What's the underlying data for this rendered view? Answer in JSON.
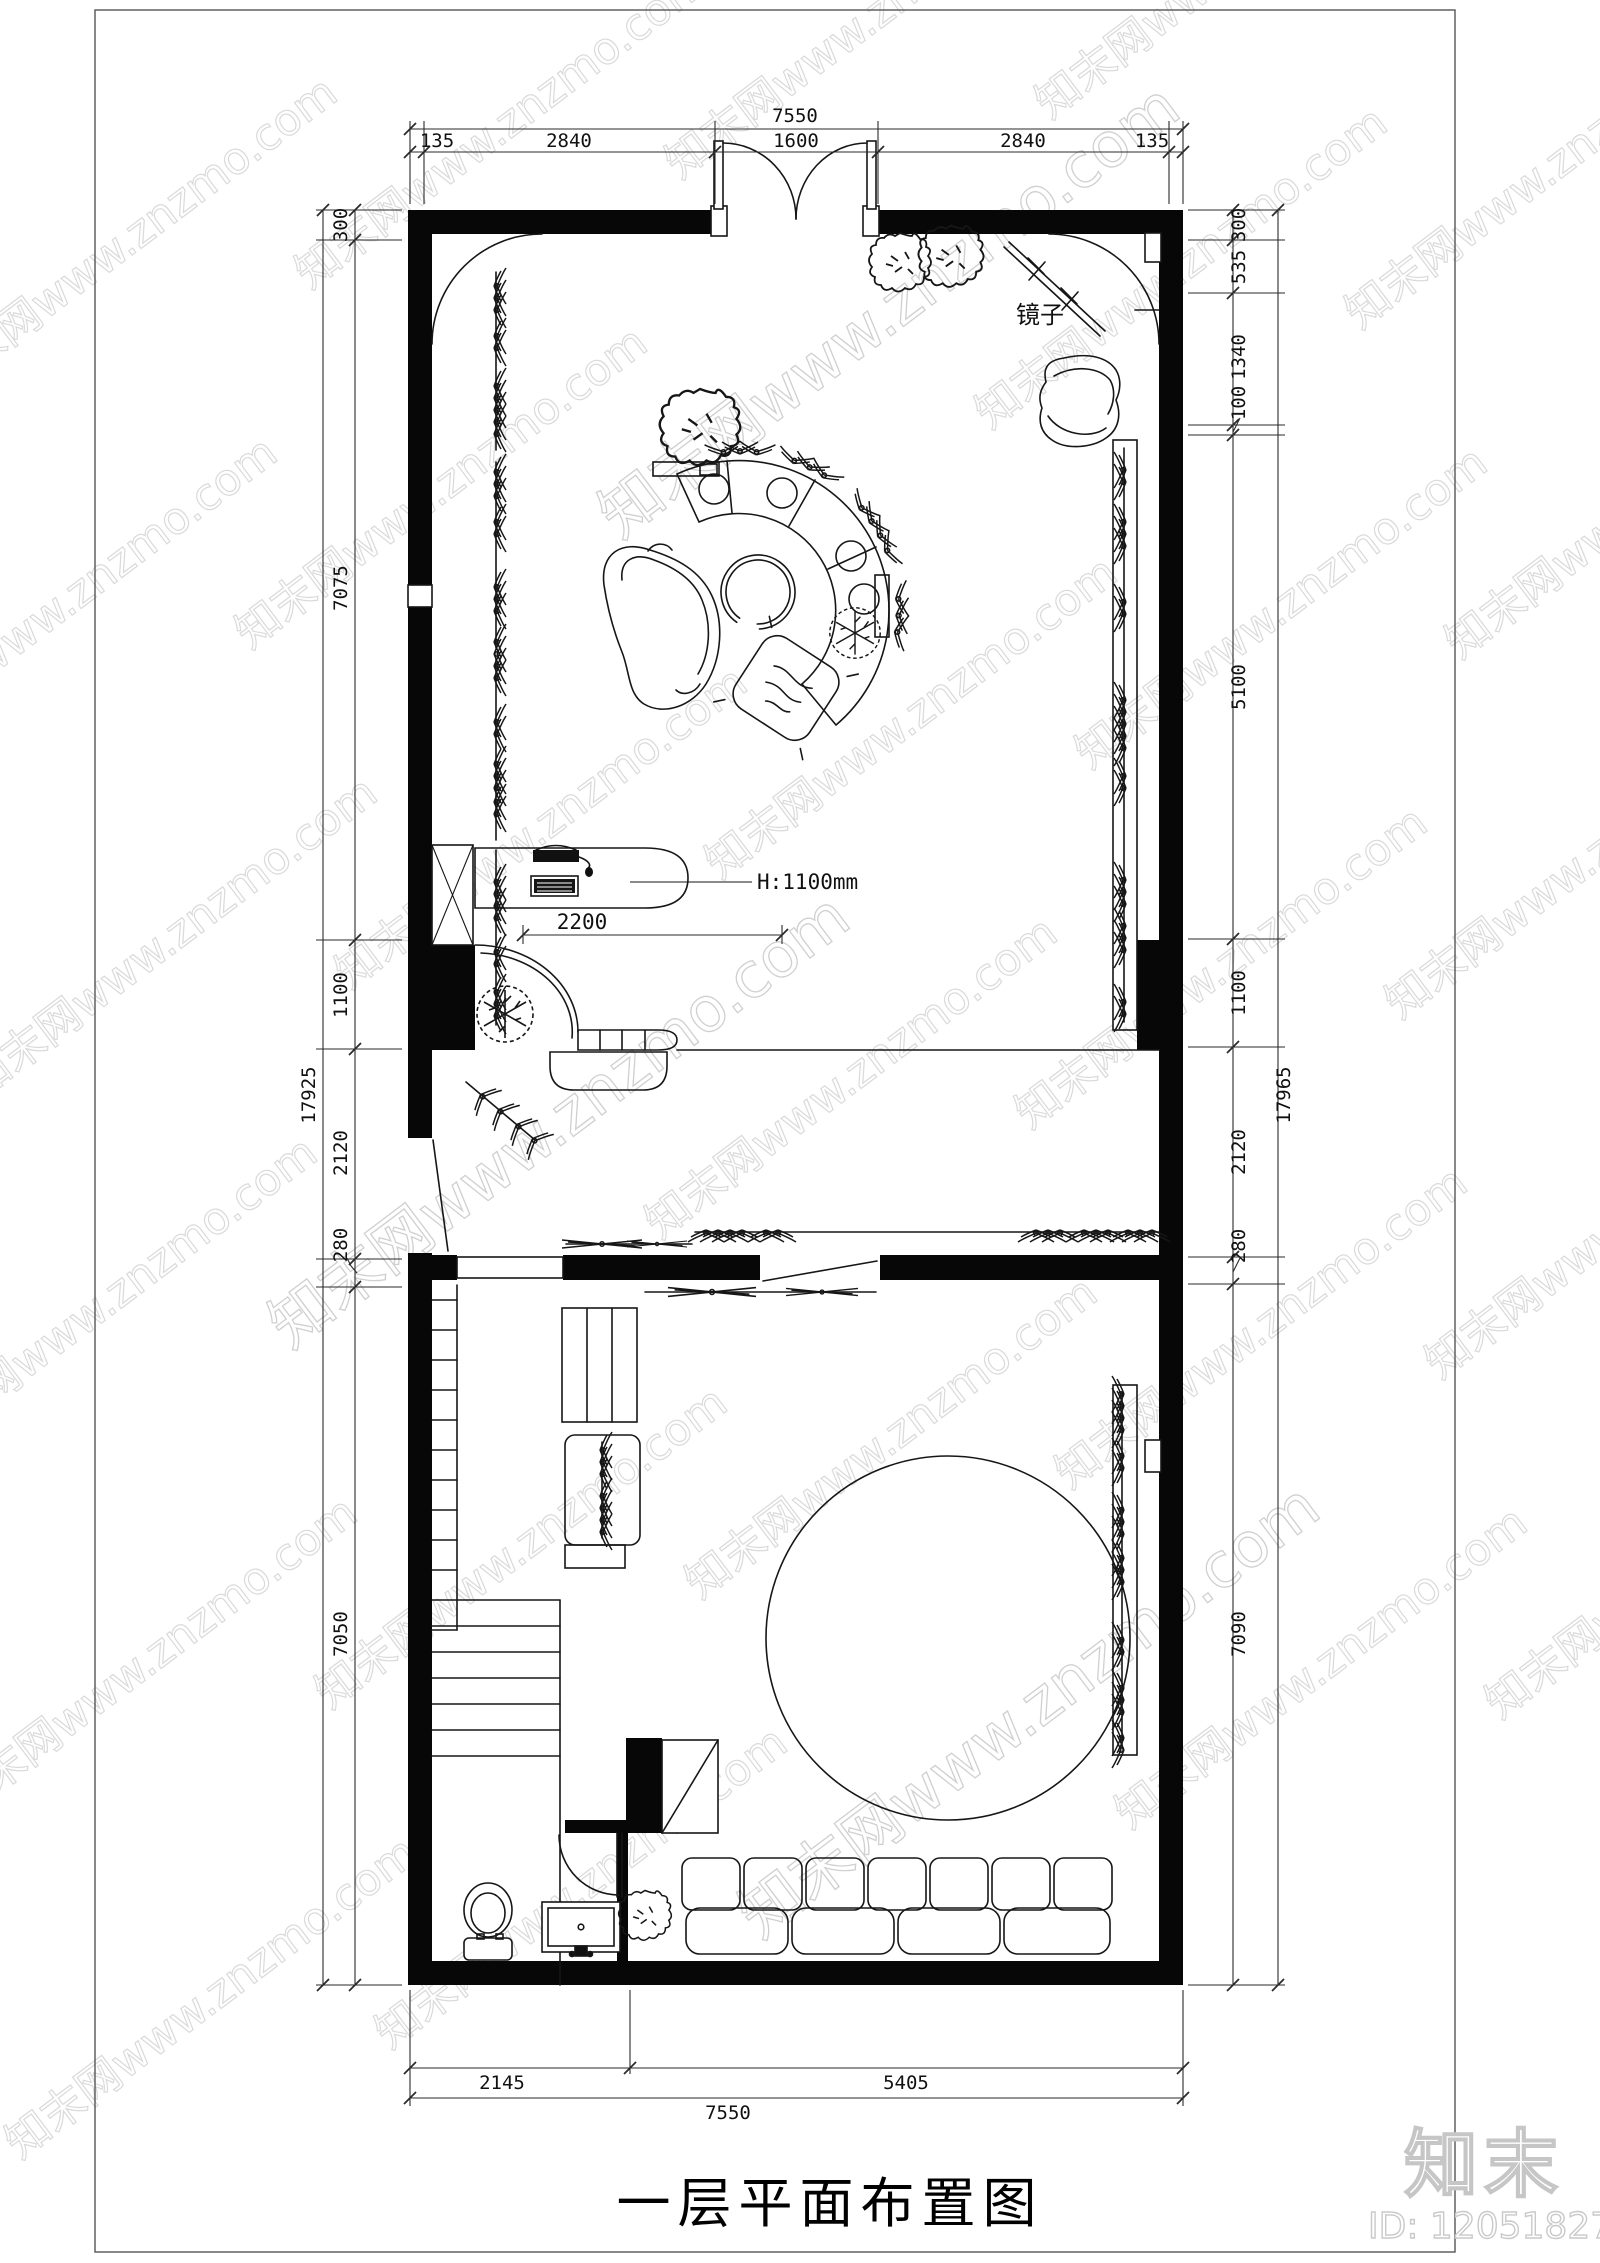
{
  "sheet": {
    "title": "一层平面布置图"
  },
  "plan": {
    "mirror_label": "镜子",
    "counter_height_label": "H:1100mm",
    "counter_width_dim": "2200"
  },
  "dims": {
    "top": {
      "total": "7550",
      "chain": [
        "135",
        "2840",
        "1600",
        "2840",
        "135"
      ]
    },
    "bottom": {
      "total": "7550",
      "chain": [
        "2145",
        "5405"
      ]
    },
    "left": {
      "total": "17925",
      "chain": [
        "300",
        "7075",
        "1100",
        "2120",
        "280",
        "7050"
      ]
    },
    "right": {
      "total": "17965",
      "chain": [
        "300",
        "535",
        "1340",
        "100",
        "5100",
        "1100",
        "2120",
        "280",
        "7090"
      ]
    }
  },
  "branding": {
    "logo": "知末",
    "id_text": "ID: 1205182749",
    "watermark": "知末网www.znzmo.com"
  }
}
